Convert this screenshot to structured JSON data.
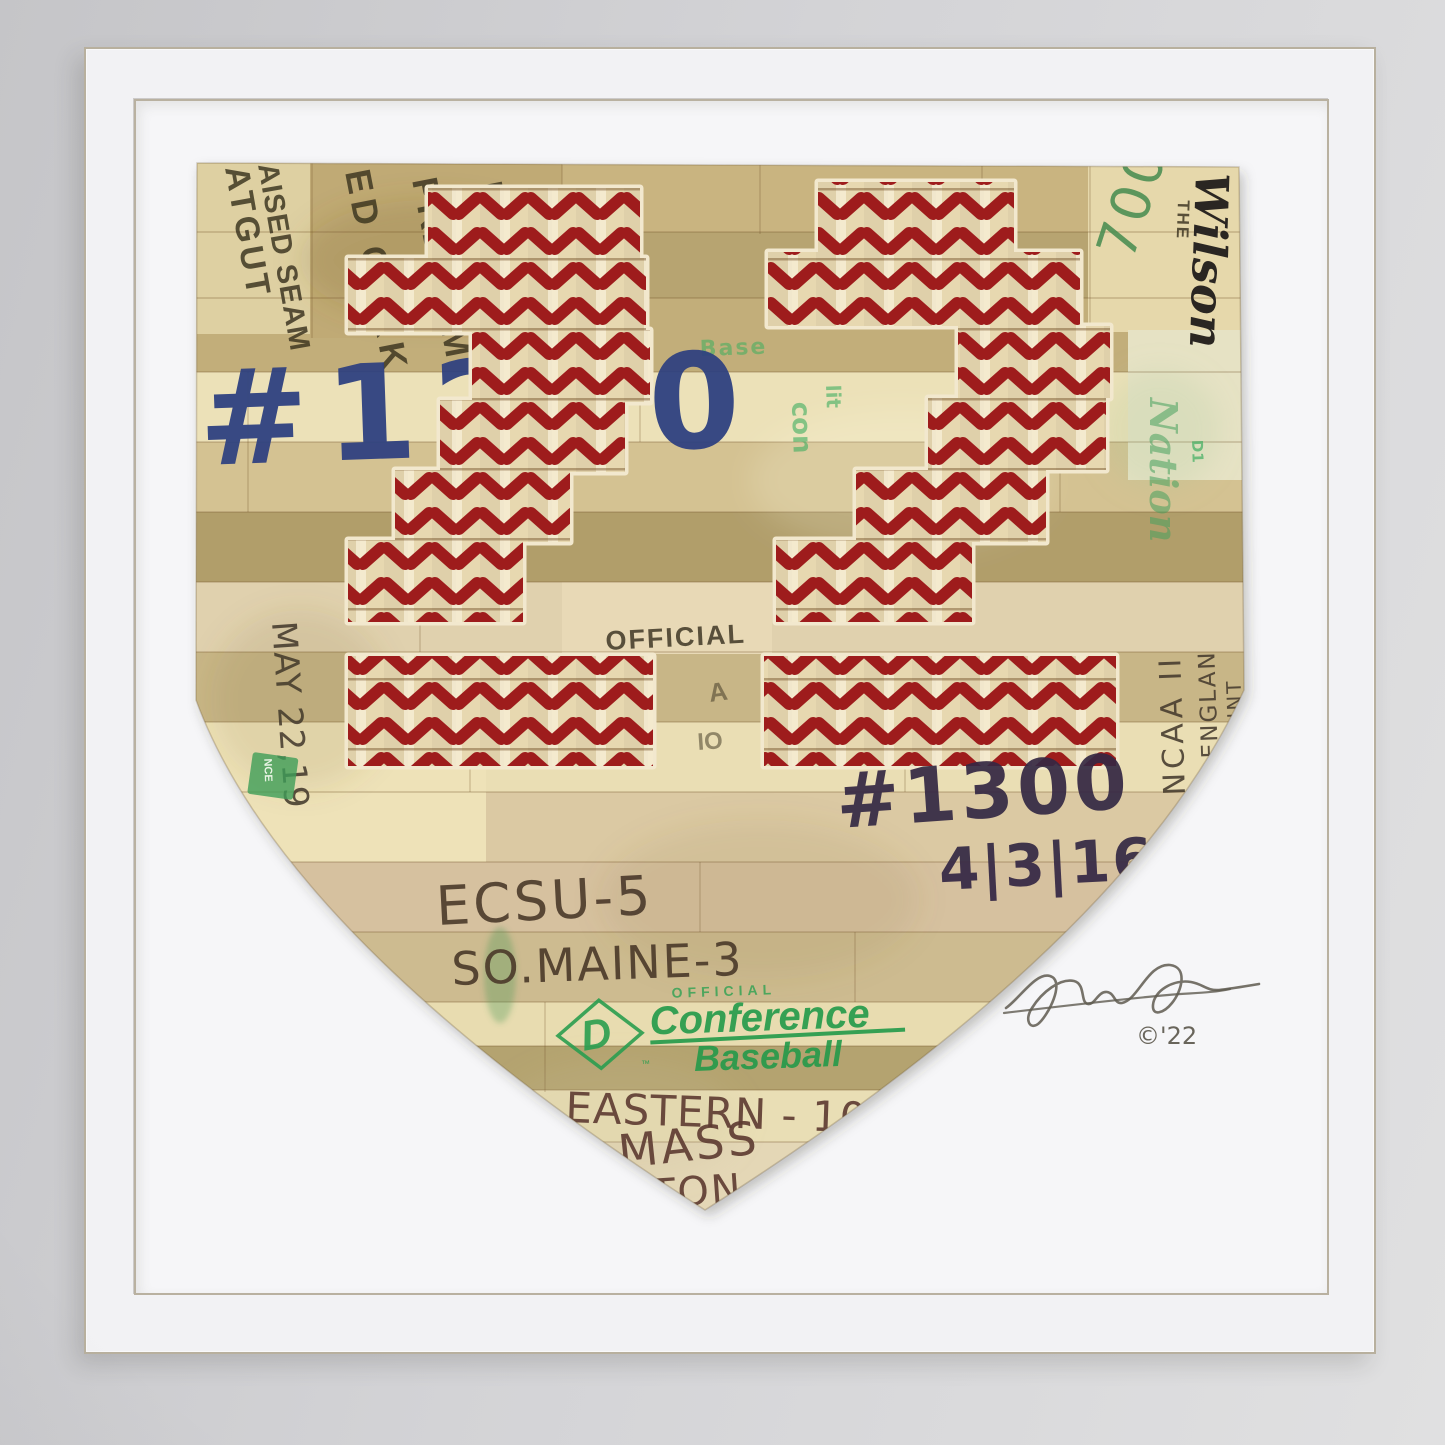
{
  "artwork": {
    "jersey_number": "22",
    "ball_stamps": {
      "col1": "ATGUT",
      "col2": "AISED SEAM",
      "col3": "ED CORK",
      "col4": "PREMIUM",
      "col5": "LEATHER",
      "col6": "HAITI",
      "official": "OFFICIAL",
      "official_partial_a": "A",
      "official_partial_io": "IO",
      "wilson_the": "THE",
      "wilson_script": "Wilson"
    },
    "handwriting": {
      "number_top": "#1200",
      "number_mid": "#1300",
      "date_mid": "4|3|16",
      "score_1": "ECSU-5",
      "score_2": "SO.MAINE-3",
      "score_3": "EASTERN - 10",
      "score_4": "MASS",
      "score_partial": "TON",
      "date_left": "MAY 22,19",
      "count_700": "700",
      "ncaa": "NCAA II",
      "england": "ENGLAN",
      "point_partial": "POINT"
    },
    "green_stamp": {
      "official": "OFFICIAL",
      "conference": "Conference",
      "baseball": "Baseball",
      "logo_d": "D",
      "tm": "™",
      "d1": "D1",
      "fragment_base": "Base",
      "fragment_lit": "lit",
      "fragment_con": "con",
      "fragment_nce": "NCE",
      "fragment_script": "Nation"
    },
    "signature": {
      "year_mark": "©'22"
    },
    "colors": {
      "stitch_red": "#9e1d1d",
      "leather": "#e7d8b0",
      "mat": "#f5f5f7",
      "wall": "#d2d2d5",
      "green": "#27a04f",
      "blue": "#2e4080",
      "purple": "#352844"
    }
  }
}
